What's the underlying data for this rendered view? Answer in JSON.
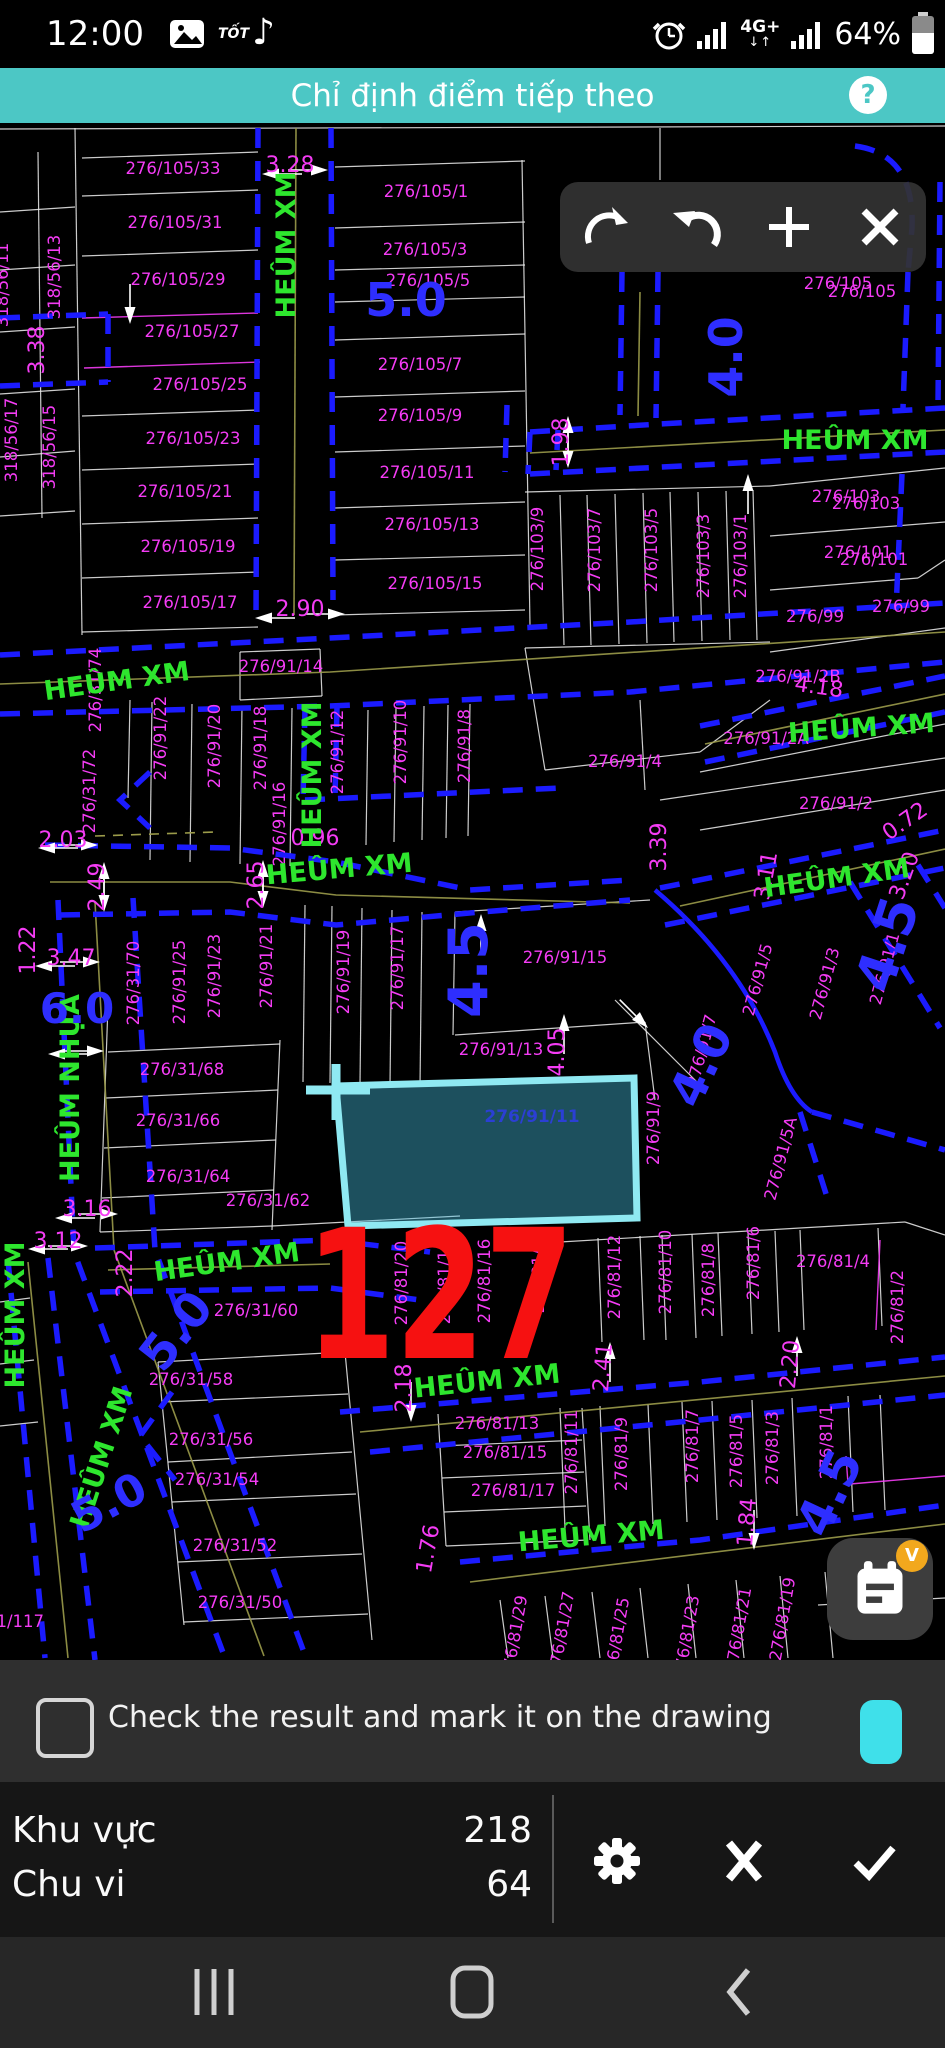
{
  "colors": {
    "accent_teal": "#4cc7c5",
    "road_blue": "#1b1bff",
    "parcel_magenta": "#f43cf4",
    "street_green": "#2ee62e",
    "width_blue": "#2e2eff",
    "marker_red": "#f61111",
    "highlight_cyan": "#8fe9f2",
    "badge_orange": "#f2a81d",
    "chip_cyan": "#3fe0ea"
  },
  "status_bar": {
    "time": "12:00",
    "app_text": "TỐT",
    "network": "4G+",
    "net_arrows": "↓↑",
    "battery_percent": "64%",
    "note_icon": "♪",
    "icons": [
      "gallery-icon",
      "tiktok-icon",
      "alarm-icon",
      "signal-icon",
      "signal-icon",
      "battery-icon"
    ]
  },
  "title_bar": {
    "title": "Chỉ định điểm tiếp theo",
    "help_label": "?"
  },
  "toolbar": {
    "buttons": [
      "arc-segment",
      "undo",
      "add-point",
      "close"
    ]
  },
  "checkbox_row": {
    "label": "Check the result and mark it on the drawing",
    "badge": "V",
    "checked": false
  },
  "results": {
    "rows": [
      {
        "label": "Khu vực",
        "value": "218"
      },
      {
        "label": "Chu vi",
        "value": "64"
      }
    ],
    "buttons": [
      "settings",
      "cancel",
      "confirm"
    ]
  },
  "fab": {
    "badge": "V",
    "icon": "notes-calendar"
  },
  "nav_bar": {
    "buttons": [
      "recents",
      "home",
      "back"
    ]
  },
  "map": {
    "selected_parcel_label": "276/91/11",
    "big_number": "127",
    "street_labels": [
      {
        "t": "HEÛM XM",
        "x": 295,
        "y": 245,
        "r": -90
      },
      {
        "t": "HEÛM XM",
        "x": 855,
        "y": 449,
        "r": 0
      },
      {
        "t": "HEÛM XM",
        "x": 862,
        "y": 737,
        "r": -4
      },
      {
        "t": "HEÛM XM",
        "x": 118,
        "y": 690,
        "r": -8
      },
      {
        "t": "HEÛM XM",
        "x": 321,
        "y": 775,
        "r": -90
      },
      {
        "t": "HEÛM XM",
        "x": 340,
        "y": 878,
        "r": -5
      },
      {
        "t": "HEÛM XM",
        "x": 838,
        "y": 887,
        "r": -8
      },
      {
        "t": "HEÛM NHỰA",
        "x": 79,
        "y": 1088,
        "r": -90
      },
      {
        "t": "HEÛM XM",
        "x": 228,
        "y": 1271,
        "r": -8
      },
      {
        "t": "HEÛM XM",
        "x": 488,
        "y": 1390,
        "r": -6
      },
      {
        "t": "HEÛM XM",
        "x": 110,
        "y": 1460,
        "r": -72
      },
      {
        "t": "HEÛM XM",
        "x": 24,
        "y": 1315,
        "r": -90
      },
      {
        "t": "HEÛM XM",
        "x": 592,
        "y": 1545,
        "r": -5
      }
    ],
    "width_labels": [
      {
        "t": "5.0",
        "x": 406,
        "y": 316,
        "r": 0,
        "fs": 46
      },
      {
        "t": "4.0",
        "x": 742,
        "y": 357,
        "r": -90,
        "fs": 46
      },
      {
        "t": "4.5",
        "x": 487,
        "y": 970,
        "r": -90,
        "fs": 54
      },
      {
        "t": "6.0",
        "x": 77,
        "y": 1023,
        "r": 0,
        "fs": 42
      },
      {
        "t": "5.0",
        "x": 189,
        "y": 1341,
        "r": -52,
        "fs": 48
      },
      {
        "t": "5.0",
        "x": 116,
        "y": 1516,
        "r": -28,
        "fs": 44
      },
      {
        "t": "4.5",
        "x": 905,
        "y": 950,
        "r": -72,
        "fs": 54
      },
      {
        "t": "4.0",
        "x": 716,
        "y": 1072,
        "r": -65,
        "fs": 48
      },
      {
        "t": "4.5",
        "x": 845,
        "y": 1500,
        "r": -65,
        "fs": 50
      }
    ],
    "parcel_labels": [
      {
        "t": "318/56/11",
        "x": 8,
        "y": 285,
        "r": -90
      },
      {
        "t": "318/56/13",
        "x": 60,
        "y": 277,
        "r": -90
      },
      {
        "t": "318/56/15",
        "x": 55,
        "y": 447,
        "r": -90
      },
      {
        "t": "318/56/17",
        "x": 17,
        "y": 440,
        "r": -90
      },
      {
        "t": "276/105/33",
        "x": 173,
        "y": 174,
        "r": 0
      },
      {
        "t": "276/105/31",
        "x": 175,
        "y": 228,
        "r": 0
      },
      {
        "t": "276/105/29",
        "x": 178,
        "y": 285,
        "r": 0
      },
      {
        "t": "276/105/27",
        "x": 192,
        "y": 337,
        "r": 0
      },
      {
        "t": "276/105/25",
        "x": 200,
        "y": 390,
        "r": 0
      },
      {
        "t": "276/105/23",
        "x": 193,
        "y": 444,
        "r": 0
      },
      {
        "t": "276/105/21",
        "x": 185,
        "y": 497,
        "r": 0
      },
      {
        "t": "276/105/19",
        "x": 188,
        "y": 552,
        "r": 0
      },
      {
        "t": "276/105/17",
        "x": 190,
        "y": 608,
        "r": 0
      },
      {
        "t": "276/105/1",
        "x": 426,
        "y": 197,
        "r": 0
      },
      {
        "t": "276/105/3",
        "x": 425,
        "y": 255,
        "r": 0
      },
      {
        "t": "276/105/5",
        "x": 428,
        "y": 286,
        "r": 0
      },
      {
        "t": "276/105/7",
        "x": 420,
        "y": 370,
        "r": 0
      },
      {
        "t": "276/105/9",
        "x": 420,
        "y": 421,
        "r": 0
      },
      {
        "t": "276/105/11",
        "x": 427,
        "y": 478,
        "r": 0
      },
      {
        "t": "276/105/13",
        "x": 432,
        "y": 530,
        "r": 0
      },
      {
        "t": "276/105/15",
        "x": 435,
        "y": 589,
        "r": 0
      },
      {
        "t": "276/105",
        "x": 838,
        "y": 289,
        "r": 0
      },
      {
        "t": "276/105",
        "x": 862,
        "y": 297,
        "r": 0
      },
      {
        "t": "276/103/9",
        "x": 543,
        "y": 549,
        "r": -90
      },
      {
        "t": "276/103/7",
        "x": 600,
        "y": 550,
        "r": -90
      },
      {
        "t": "276/103/5",
        "x": 657,
        "y": 550,
        "r": -90
      },
      {
        "t": "276/103/3",
        "x": 709,
        "y": 556,
        "r": -90
      },
      {
        "t": "276/103/1",
        "x": 746,
        "y": 556,
        "r": -90
      },
      {
        "t": "276/103",
        "x": 846,
        "y": 502,
        "r": 0
      },
      {
        "t": "276/103",
        "x": 866,
        "y": 509,
        "r": 0
      },
      {
        "t": "276/101",
        "x": 858,
        "y": 558,
        "r": 0
      },
      {
        "t": "276/101",
        "x": 874,
        "y": 565,
        "r": 0
      },
      {
        "t": "276/99",
        "x": 901,
        "y": 612,
        "r": 0
      },
      {
        "t": "276/99",
        "x": 815,
        "y": 622,
        "r": 0
      },
      {
        "t": "276/91/14",
        "x": 281,
        "y": 672,
        "r": 0
      },
      {
        "t": "276/31/74",
        "x": 101,
        "y": 690,
        "r": -90
      },
      {
        "t": "276/31/72",
        "x": 95,
        "y": 791,
        "r": -90
      },
      {
        "t": "276/91/22",
        "x": 166,
        "y": 738,
        "r": -90
      },
      {
        "t": "276/91/20",
        "x": 220,
        "y": 746,
        "r": -90
      },
      {
        "t": "276/91/18",
        "x": 266,
        "y": 748,
        "r": -90
      },
      {
        "t": "276/91/16",
        "x": 285,
        "y": 824,
        "r": -90
      },
      {
        "t": "276/91/12",
        "x": 343,
        "y": 752,
        "r": -90
      },
      {
        "t": "276/91/10",
        "x": 406,
        "y": 742,
        "r": -90
      },
      {
        "t": "276/91/8",
        "x": 470,
        "y": 746,
        "r": -90
      },
      {
        "t": "276/91/4",
        "x": 625,
        "y": 767,
        "r": 0
      },
      {
        "t": "276/91/2B",
        "x": 798,
        "y": 682,
        "r": 0
      },
      {
        "t": "276/91/2A",
        "x": 766,
        "y": 744,
        "r": 0
      },
      {
        "t": "276/91/2",
        "x": 836,
        "y": 809,
        "r": 0
      },
      {
        "t": "276/91/15",
        "x": 565,
        "y": 963,
        "r": 0
      },
      {
        "t": "276/91/13",
        "x": 501,
        "y": 1055,
        "r": 0
      },
      {
        "t": "276/91/21",
        "x": 272,
        "y": 966,
        "r": -90
      },
      {
        "t": "276/91/19",
        "x": 349,
        "y": 972,
        "r": -90
      },
      {
        "t": "276/91/17",
        "x": 403,
        "y": 968,
        "r": -90
      },
      {
        "t": "276/91/25",
        "x": 185,
        "y": 982,
        "r": -90
      },
      {
        "t": "276/91/23",
        "x": 220,
        "y": 976,
        "r": -90
      },
      {
        "t": "276/31/70",
        "x": 139,
        "y": 983,
        "r": -90
      },
      {
        "t": "276/31/68",
        "x": 182,
        "y": 1075,
        "r": 0
      },
      {
        "t": "276/31/66",
        "x": 178,
        "y": 1126,
        "r": 0
      },
      {
        "t": "276/31/64",
        "x": 188,
        "y": 1182,
        "r": 0
      },
      {
        "t": "276/31/62",
        "x": 268,
        "y": 1206,
        "r": 0
      },
      {
        "t": "276/31/60",
        "x": 256,
        "y": 1316,
        "r": 0
      },
      {
        "t": "276/31/58",
        "x": 191,
        "y": 1385,
        "r": 0
      },
      {
        "t": "276/31/56",
        "x": 211,
        "y": 1445,
        "r": 0
      },
      {
        "t": "276/31/54",
        "x": 217,
        "y": 1485,
        "r": 0
      },
      {
        "t": "276/31/52",
        "x": 235,
        "y": 1551,
        "r": 0
      },
      {
        "t": "276/31/50",
        "x": 240,
        "y": 1608,
        "r": 0
      },
      {
        "t": "276/91/9",
        "x": 659,
        "y": 1128,
        "r": -90
      },
      {
        "t": "276/91/7",
        "x": 707,
        "y": 1052,
        "r": -75
      },
      {
        "t": "276/91/5",
        "x": 763,
        "y": 981,
        "r": -75
      },
      {
        "t": "276/91/3",
        "x": 830,
        "y": 985,
        "r": -75
      },
      {
        "t": "276/91/1",
        "x": 890,
        "y": 970,
        "r": -75
      },
      {
        "t": "276/91/5A",
        "x": 786,
        "y": 1160,
        "r": -75
      },
      {
        "t": "276/81/20",
        "x": 407,
        "y": 1283,
        "r": -90
      },
      {
        "t": "276/81/18",
        "x": 450,
        "y": 1282,
        "r": -90
      },
      {
        "t": "276/81/16",
        "x": 490,
        "y": 1281,
        "r": -90
      },
      {
        "t": "276/81/14",
        "x": 544,
        "y": 1271,
        "r": -90
      },
      {
        "t": "276/81/13",
        "x": 497,
        "y": 1429,
        "r": 0
      },
      {
        "t": "276/81/15",
        "x": 505,
        "y": 1458,
        "r": 0
      },
      {
        "t": "276/81/17",
        "x": 513,
        "y": 1496,
        "r": 0
      },
      {
        "t": "276/81/11",
        "x": 577,
        "y": 1452,
        "r": -90
      },
      {
        "t": "276/81/12",
        "x": 620,
        "y": 1277,
        "r": -90
      },
      {
        "t": "276/81/10",
        "x": 671,
        "y": 1272,
        "r": -90
      },
      {
        "t": "276/81/8",
        "x": 714,
        "y": 1280,
        "r": -90
      },
      {
        "t": "276/81/6",
        "x": 759,
        "y": 1263,
        "r": -90
      },
      {
        "t": "276/81/4",
        "x": 833,
        "y": 1267,
        "r": 0
      },
      {
        "t": "276/81/2",
        "x": 903,
        "y": 1307,
        "r": -90
      },
      {
        "t": "276/81/9",
        "x": 627,
        "y": 1454,
        "r": -90
      },
      {
        "t": "276/81/7",
        "x": 698,
        "y": 1446,
        "r": -90
      },
      {
        "t": "276/81/5",
        "x": 742,
        "y": 1451,
        "r": -90
      },
      {
        "t": "276/81/3",
        "x": 778,
        "y": 1448,
        "r": -90
      },
      {
        "t": "276/81/1",
        "x": 832,
        "y": 1442,
        "r": -90
      },
      {
        "t": "276/81/29",
        "x": 520,
        "y": 1638,
        "r": -80
      },
      {
        "t": "276/81/27",
        "x": 567,
        "y": 1634,
        "r": -80
      },
      {
        "t": "276/81/25",
        "x": 622,
        "y": 1640,
        "r": -80
      },
      {
        "t": "276/81/23",
        "x": 692,
        "y": 1638,
        "r": -80
      },
      {
        "t": "276/81/21",
        "x": 744,
        "y": 1630,
        "r": -80
      },
      {
        "t": "276/81/19",
        "x": 788,
        "y": 1620,
        "r": -80
      },
      {
        "t": "31/117",
        "x": 15,
        "y": 1627,
        "r": 0
      }
    ],
    "dim_labels": [
      {
        "t": "3.28",
        "x": 290,
        "y": 172,
        "r": 0
      },
      {
        "t": "3.38",
        "x": 44,
        "y": 350,
        "r": -90
      },
      {
        "t": "2.90",
        "x": 300,
        "y": 616,
        "r": 0
      },
      {
        "t": "1.98",
        "x": 568,
        "y": 442,
        "r": -90
      },
      {
        "t": "2.03",
        "x": 63,
        "y": 847,
        "r": 0
      },
      {
        "t": "0.96",
        "x": 315,
        "y": 845,
        "r": 0
      },
      {
        "t": "2.49",
        "x": 104,
        "y": 887,
        "r": -90
      },
      {
        "t": "2.65",
        "x": 263,
        "y": 885,
        "r": -90
      },
      {
        "t": "3.47",
        "x": 71,
        "y": 965,
        "r": 0
      },
      {
        "t": "1.22",
        "x": 35,
        "y": 950,
        "r": -90
      },
      {
        "t": "4.05",
        "x": 564,
        "y": 1052,
        "r": -90
      },
      {
        "t": "3.39",
        "x": 666,
        "y": 847,
        "r": -90
      },
      {
        "t": "3.11",
        "x": 773,
        "y": 877,
        "r": -80
      },
      {
        "t": "0.72",
        "x": 909,
        "y": 827,
        "r": -35
      },
      {
        "t": "3.20",
        "x": 911,
        "y": 878,
        "r": -70
      },
      {
        "t": "4.18",
        "x": 818,
        "y": 694,
        "r": 8
      },
      {
        "t": "3.16",
        "x": 87,
        "y": 1216,
        "r": 0
      },
      {
        "t": "3.12",
        "x": 58,
        "y": 1248,
        "r": 0
      },
      {
        "t": "2.22",
        "x": 132,
        "y": 1273,
        "r": -90
      },
      {
        "t": "2.18",
        "x": 411,
        "y": 1388,
        "r": -90
      },
      {
        "t": "2.41",
        "x": 610,
        "y": 1368,
        "r": -85
      },
      {
        "t": "2.20",
        "x": 797,
        "y": 1365,
        "r": -85
      },
      {
        "t": "1.84",
        "x": 754,
        "y": 1523,
        "r": -85
      },
      {
        "t": "1.76",
        "x": 435,
        "y": 1550,
        "r": -80
      }
    ]
  }
}
